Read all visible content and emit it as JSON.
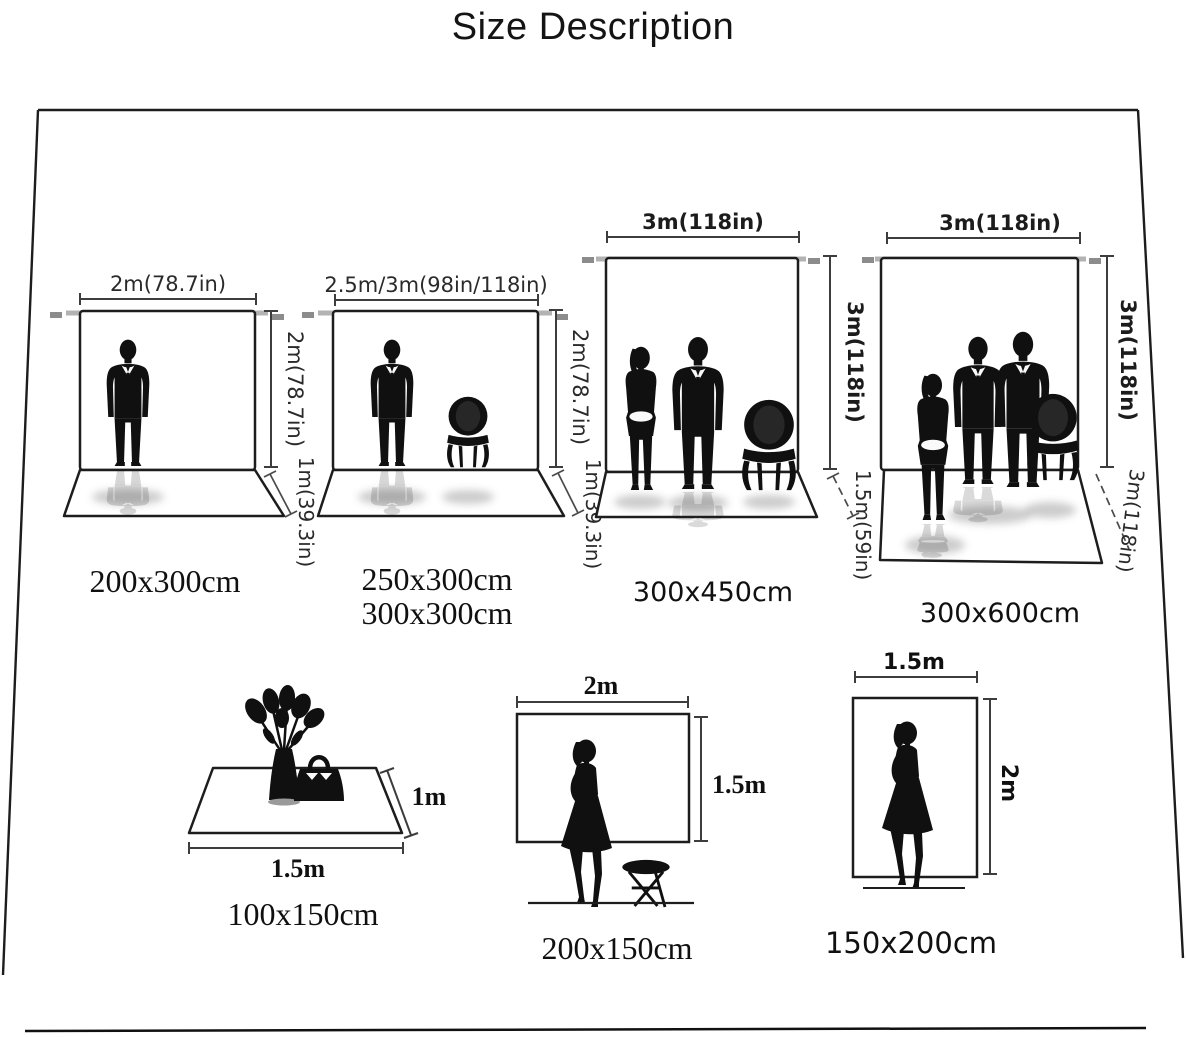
{
  "title": "Size Description",
  "backdrops": [
    {
      "top": "2m(78.7in)",
      "side": "2m(78.7in)",
      "floor": "1m(39.3in)",
      "size": "200x300cm"
    },
    {
      "top": "2.5m/3m(98in/118in)",
      "side": "2m(78.7in)",
      "floor": "1m(39.3in)",
      "size": "250x300cm",
      "size2": "300x300cm"
    },
    {
      "top": "3m(118in)",
      "side": "3m(118in)",
      "floor": "1.5m(59in)",
      "size": "300x450cm"
    },
    {
      "top": "3m(118in)",
      "side": "3m(118in)",
      "floor": "3m(118in)",
      "size": "300x600cm"
    }
  ],
  "flat_items": [
    {
      "width": "1.5m",
      "height": "1m",
      "size": "100x150cm"
    },
    {
      "width": "2m",
      "height": "1.5m",
      "size": "200x150cm"
    },
    {
      "width": "1.5m",
      "height": "2m",
      "size": "150x200cm"
    }
  ],
  "colors": {
    "ink": "#101010",
    "dimension_line": "#3d3d3d",
    "stand_bar": "#b3b3b3",
    "stand_tip": "#8c8c8c"
  }
}
